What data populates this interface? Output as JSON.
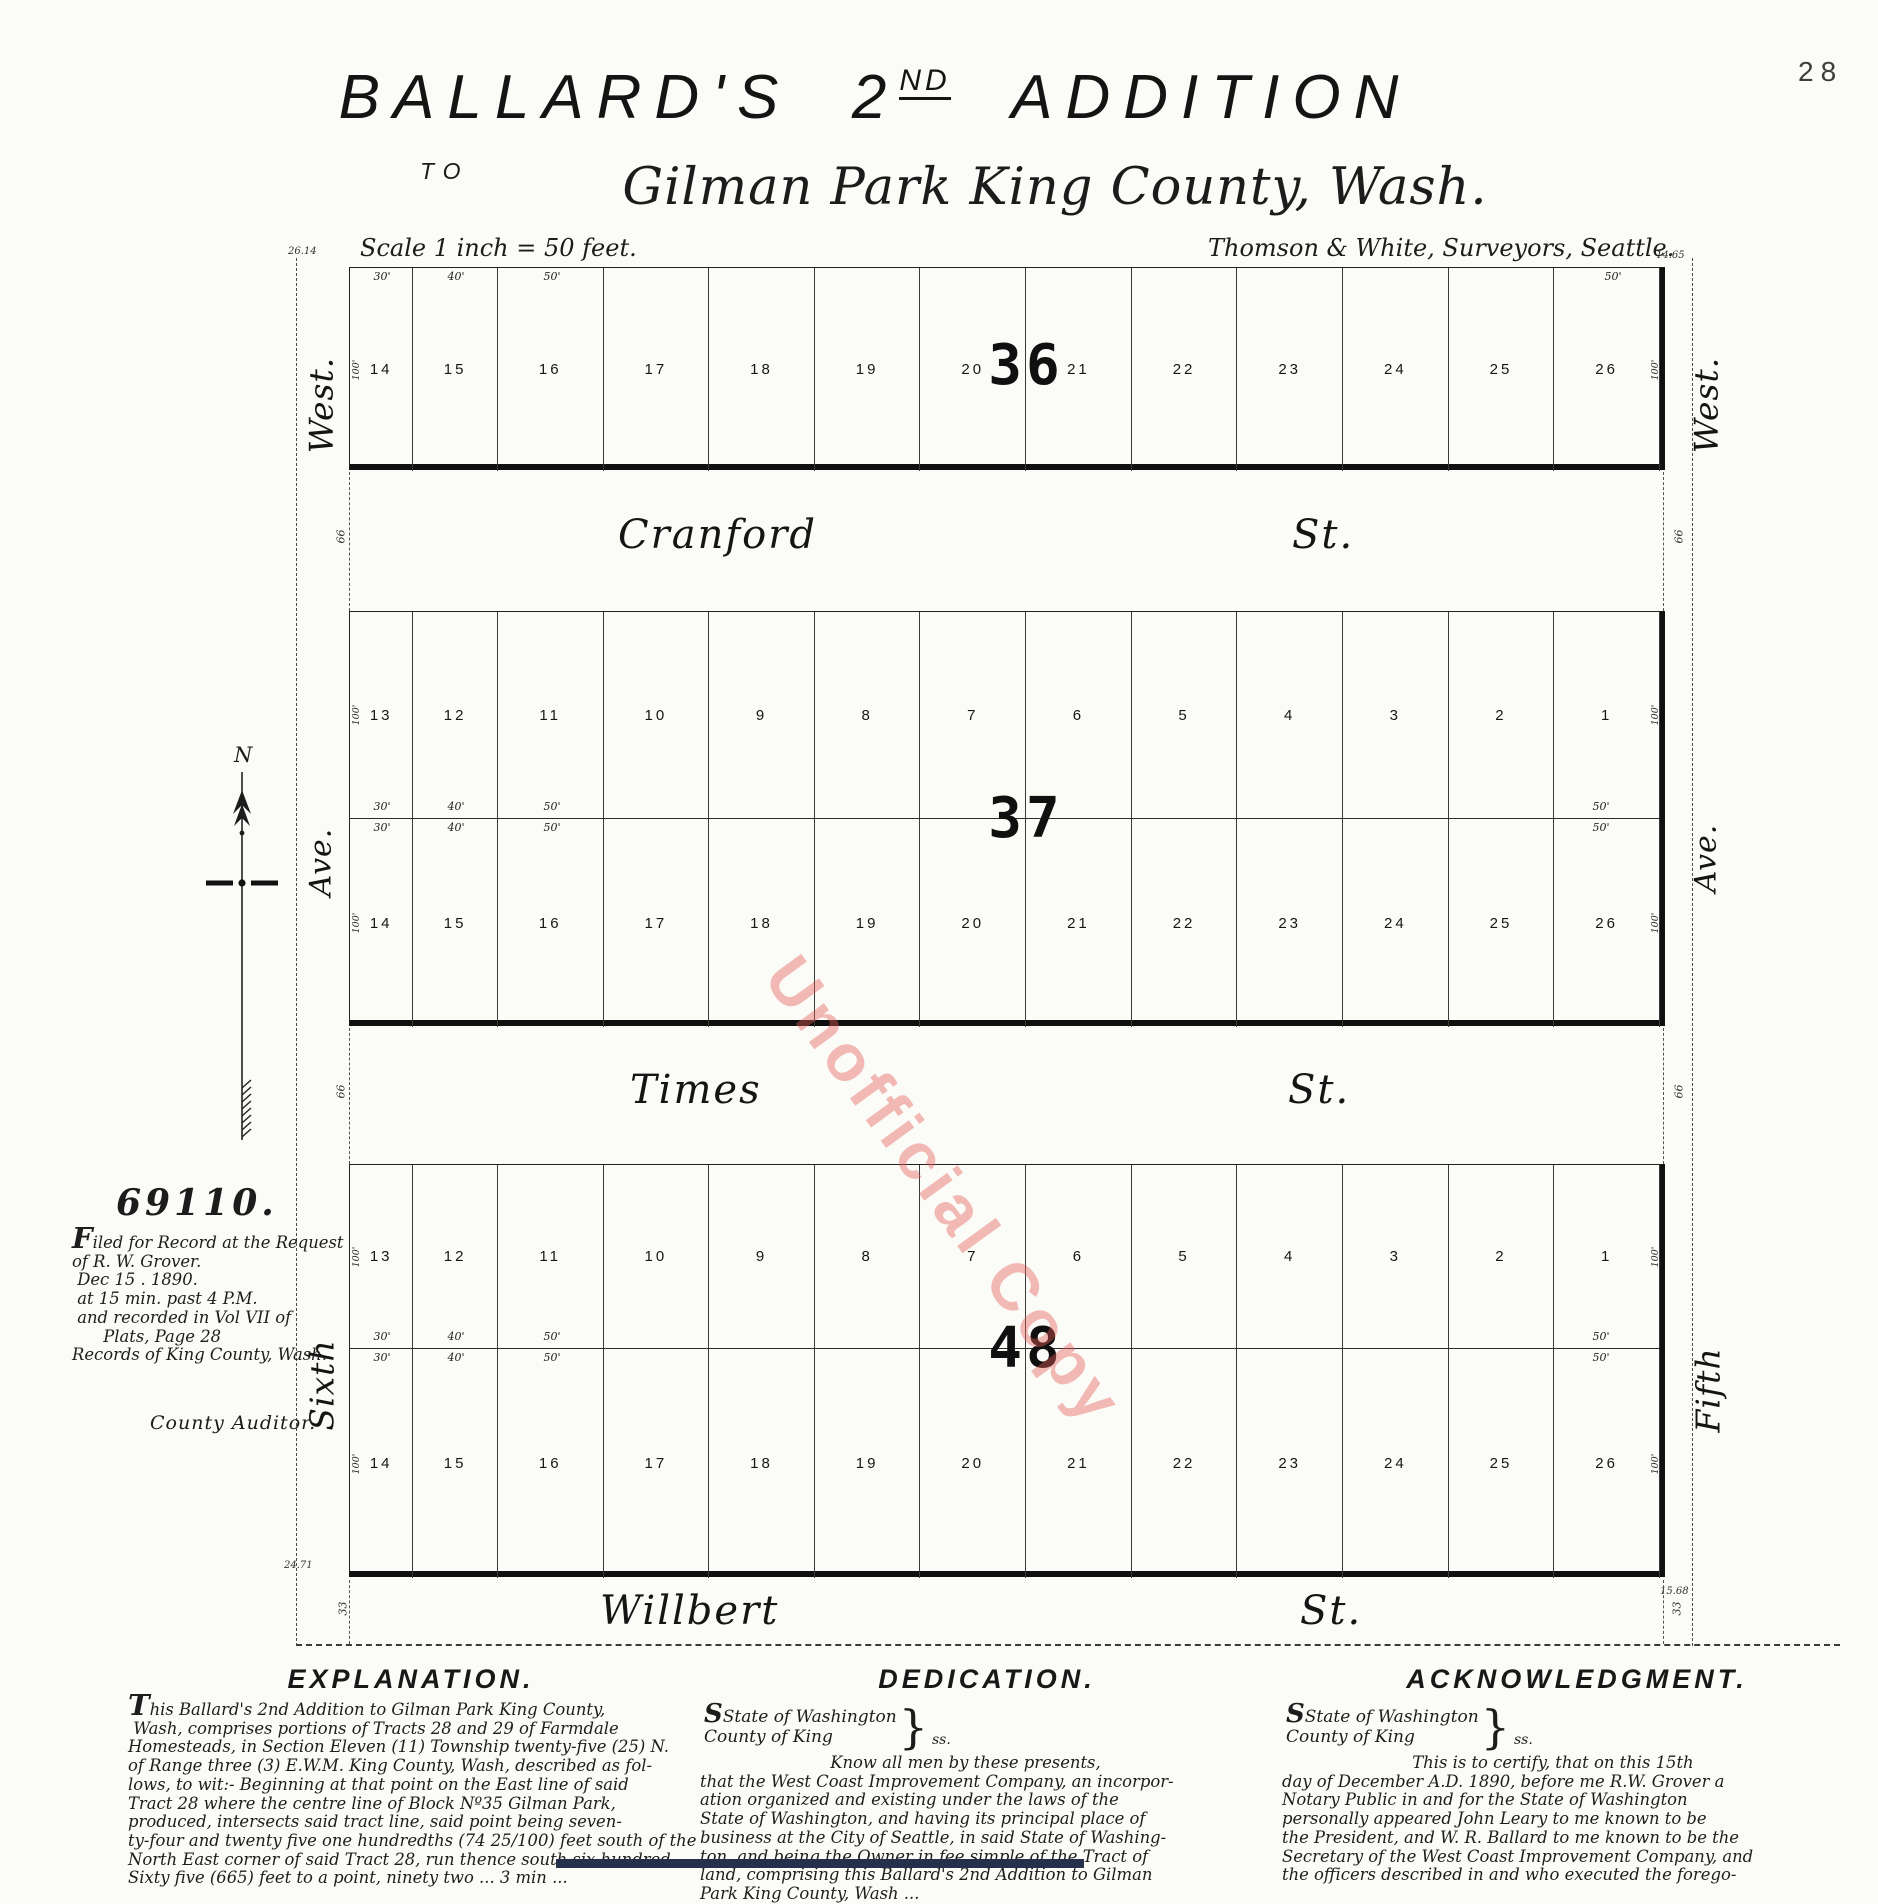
{
  "page": {
    "number": "28"
  },
  "title": {
    "word1": "BALLARD'S",
    "num": "2",
    "num_sup": "ND",
    "word2": "ADDITION",
    "to": "TO",
    "subtitle": "Gilman Park King County, Wash."
  },
  "scale_note": "Scale 1 inch = 50 feet.",
  "surveyors": "Thomson & White, Surveyors, Seattle.",
  "watermark": "Unofficial Copy",
  "north_label": "N",
  "filing": {
    "number": "69110.",
    "lines": [
      "Filed for Record at the Request",
      "of R. W. Grover.",
      " Dec 15 . 1890.",
      " at 15 min. past 4 P.M.",
      " and recorded in Vol VII of",
      "      Plats, Page 28",
      "Records of King County, Wash."
    ],
    "signature": "County Auditor."
  },
  "plat": {
    "lot_width_feet": [
      30,
      40,
      50,
      50,
      50,
      50,
      50,
      50,
      50,
      50,
      50,
      50,
      50
    ],
    "dims": {
      "top": [
        "30'",
        "40'",
        "50'"
      ],
      "right": "50'",
      "side": "100'",
      "street_full": "66",
      "street_half": "33"
    },
    "corner_dims": {
      "top_left": "26.14",
      "top_right": "14.65",
      "bottom_left": "24.71",
      "bottom_right": "15.68"
    },
    "edge_labels": {
      "left": [
        "West.",
        "Ave.",
        "Sixth"
      ],
      "right": [
        "West.",
        "Ave.",
        "Fifth"
      ]
    },
    "streets": [
      {
        "name": "Cranford",
        "suffix": "St."
      },
      {
        "name": "Times",
        "suffix": "St."
      },
      {
        "name": "Willbert",
        "suffix": "St."
      }
    ],
    "blocks": [
      {
        "number": "36",
        "rows": [
          [
            "14",
            "15",
            "16",
            "17",
            "18",
            "19",
            "20",
            "21",
            "22",
            "23",
            "24",
            "25",
            "26"
          ]
        ]
      },
      {
        "number": "37",
        "rows": [
          [
            "13",
            "12",
            "11",
            "10",
            "9",
            "8",
            "7",
            "6",
            "5",
            "4",
            "3",
            "2",
            "1"
          ],
          [
            "14",
            "15",
            "16",
            "17",
            "18",
            "19",
            "20",
            "21",
            "22",
            "23",
            "24",
            "25",
            "26"
          ]
        ]
      },
      {
        "number": "48",
        "rows": [
          [
            "13",
            "12",
            "11",
            "10",
            "9",
            "8",
            "7",
            "6",
            "5",
            "4",
            "3",
            "2",
            "1"
          ],
          [
            "14",
            "15",
            "16",
            "17",
            "18",
            "19",
            "20",
            "21",
            "22",
            "23",
            "24",
            "25",
            "26"
          ]
        ]
      }
    ]
  },
  "sections": [
    {
      "title": "EXPLANATION.",
      "lines": [
        "This Ballard's 2nd Addition to Gilman Park King County,",
        " Wash, comprises portions of Tracts 28 and 29 of Farmdale",
        "Homesteads, in Section Eleven (11) Township twenty-five (25) N.",
        "of Range three (3) E.W.M. King County, Wash, described as fol-",
        "lows, to wit:- Beginning at that point on the East line of said",
        "Tract 28 where the centre line of Block Nº35 Gilman Park,",
        "produced, intersects said tract line, said point being seven-",
        "ty-four and twenty five one hundredths (74 25/100) feet south of the",
        "North East corner of said Tract 28, run thence south six hundred",
        "Sixty five (665) feet to a point, ninety two ... 3 min ..."
      ]
    },
    {
      "title": "DEDICATION.",
      "sworn": {
        "line1": "State of Washington",
        "line2": "County of King",
        "brace": "}",
        "ss": "ss."
      },
      "lines": [
        "                         Know all men by these presents,",
        "that the West Coast Improvement Company, an incorpor-",
        "ation organized and existing under the laws of the",
        "State of Washington, and having its principal place of",
        "business at the City of Seattle, in said State of Washing-",
        "ton, and being the Owner in fee simple of the Tract of",
        "land, comprising this Ballard's 2nd Addition to Gilman",
        "Park King County, Wash ..."
      ]
    },
    {
      "title": "ACKNOWLEDGMENT.",
      "sworn": {
        "line1": "State of Washington",
        "line2": "County of King",
        "brace": "}",
        "ss": "ss."
      },
      "lines": [
        "                         This is to certify, that on this 15th",
        "day of December A.D. 1890, before me R.W. Grover a",
        "Notary Public in and for the State of Washington",
        "personally appeared John Leary to me known to be",
        "the President, and W. R. Ballard to me known to be the",
        "Secretary of the West Coast Improvement Company, and",
        "the officers described in and who executed the forego-"
      ]
    }
  ]
}
